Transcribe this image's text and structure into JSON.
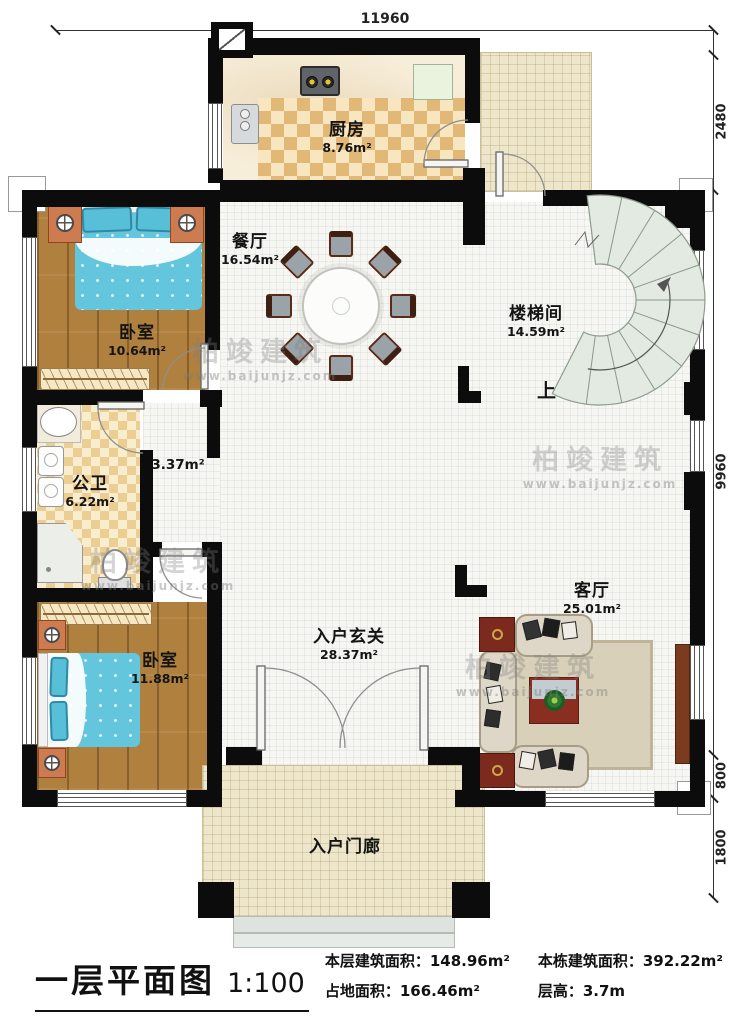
{
  "watermark": {
    "name": "柏竣建筑",
    "url": "www.baijunjz.com"
  },
  "dimensions": {
    "top": "11960",
    "right": [
      "2480",
      "9960",
      "800",
      "1800"
    ]
  },
  "stair": {
    "up": "上"
  },
  "rooms": {
    "kitchen": {
      "name": "厨房",
      "area": "8.76m²"
    },
    "dining": {
      "name": "餐厅",
      "area": "16.54m²"
    },
    "bedroom1": {
      "name": "卧室",
      "area": "10.64m²"
    },
    "stairwell": {
      "name": "楼梯间",
      "area": "14.59m²"
    },
    "bathroom": {
      "name": "公卫",
      "area": "6.22m²"
    },
    "corridor": {
      "area": "3.37m²"
    },
    "bedroom2": {
      "name": "卧室",
      "area": "11.88m²"
    },
    "foyer": {
      "name": "入户玄关",
      "area": "28.37m²"
    },
    "living": {
      "name": "客厅",
      "area": "25.01m²"
    },
    "porch": {
      "name": "入户门廊"
    }
  },
  "title_block": {
    "plan_name": "一层平面图",
    "scale": "1:100",
    "stats": [
      {
        "label": "本层建筑面积：",
        "value": "148.96m²"
      },
      {
        "label": "本栋建筑面积：",
        "value": "392.22m²"
      },
      {
        "label": "占地面积：",
        "value": "166.46m²"
      },
      {
        "label": "层高：",
        "value": "3.7m"
      }
    ]
  },
  "colors": {
    "wall": "#0c0c0c",
    "bed": "#63c6dd",
    "wood": "#b0803f",
    "stair": "#e3eae2",
    "accent_table": "#8a2e22"
  }
}
